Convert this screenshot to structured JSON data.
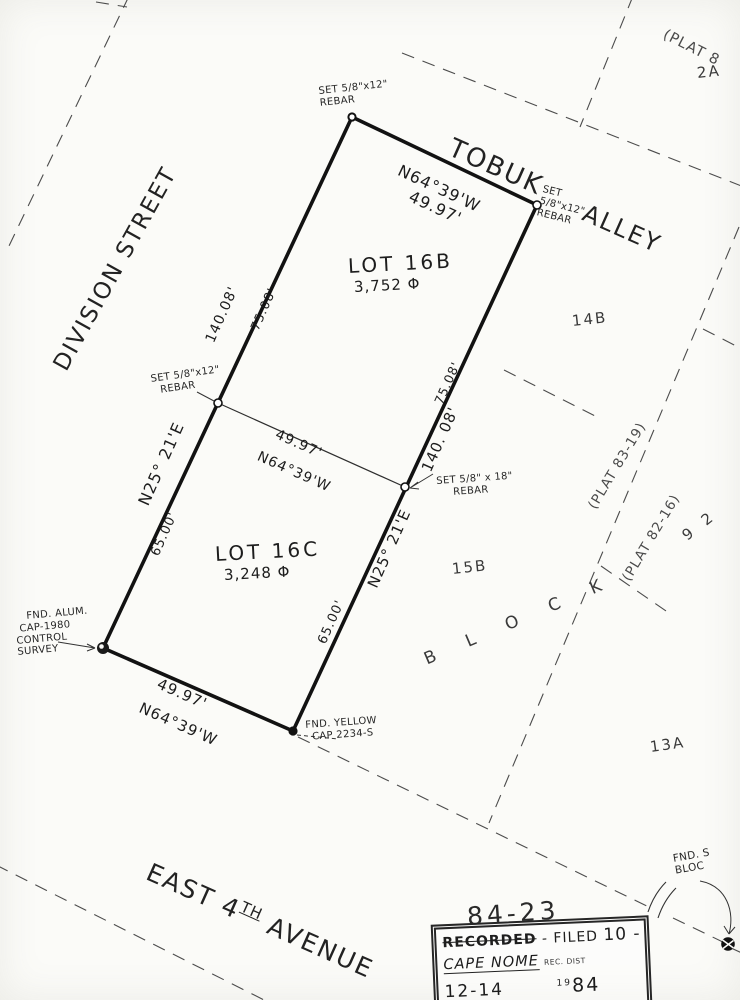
{
  "streets": {
    "division": "DIVISION  STREET",
    "tobuk": "TOBUK",
    "alley": "ALLEY",
    "avenue": {
      "part1": "EAST 4",
      "sup": "TH",
      "part2": " AVENUE"
    }
  },
  "lots": {
    "lot16b": {
      "name": "LOT  16B",
      "area": "3,752",
      "unit": "Φ"
    },
    "lot16c": {
      "name": "LOT  16C",
      "area": "3,248",
      "unit": "Φ"
    }
  },
  "adjacent": {
    "a2": "2A",
    "b14": "14B",
    "b15": "15B",
    "a13": "13A",
    "n92": "9 2",
    "block": "B L O C K"
  },
  "plats": {
    "p8319": "(PLAT  83-19)",
    "p8216": "(PLAT  82-16)",
    "p8cut": "(PLAT 8"
  },
  "dims": {
    "top_bearing": "N64°39'W",
    "top_dist": "49.97'",
    "mid_dist": "49.97'",
    "mid_bearing": "N64°39'W",
    "bot_dist": "49.97'",
    "bot_bearing": "N64°39'W",
    "left_total": "140.08'",
    "left_upper": "75.08'",
    "left_bearing": "N25° 21'E",
    "left_lower": "65.00'",
    "right_upper": "75.08'",
    "right_total": "140. 08'",
    "right_bearing": "N25° 21'E",
    "right_lower": "65.00'"
  },
  "markers": {
    "top": [
      "SET 5/8\"x12\"",
      "REBAR"
    ],
    "ne": [
      "SET",
      "5/8\"x12\"",
      "REBAR"
    ],
    "mid_left": [
      "SET 5/8\"x12\"",
      "REBAR"
    ],
    "mid_right": [
      "SET 5/8\" x 18\"",
      "REBAR"
    ],
    "sw": [
      "FND. ALUM.",
      "CAP-1980",
      "CONTROL",
      "SURVEY"
    ],
    "south": [
      "FND. YELLOW",
      "CAP 2234-S"
    ],
    "se": [
      "FND. S",
      "BLOC"
    ]
  },
  "annotations": {
    "plat_number": "84-23"
  },
  "stamp": {
    "recorded": "RECORDED",
    "filed": "- FILED",
    "num": "10 -",
    "office": "CAPE NOME",
    "dist": "REC. DIST",
    "date_left": "12-14",
    "year_small": "19",
    "year": "84"
  }
}
